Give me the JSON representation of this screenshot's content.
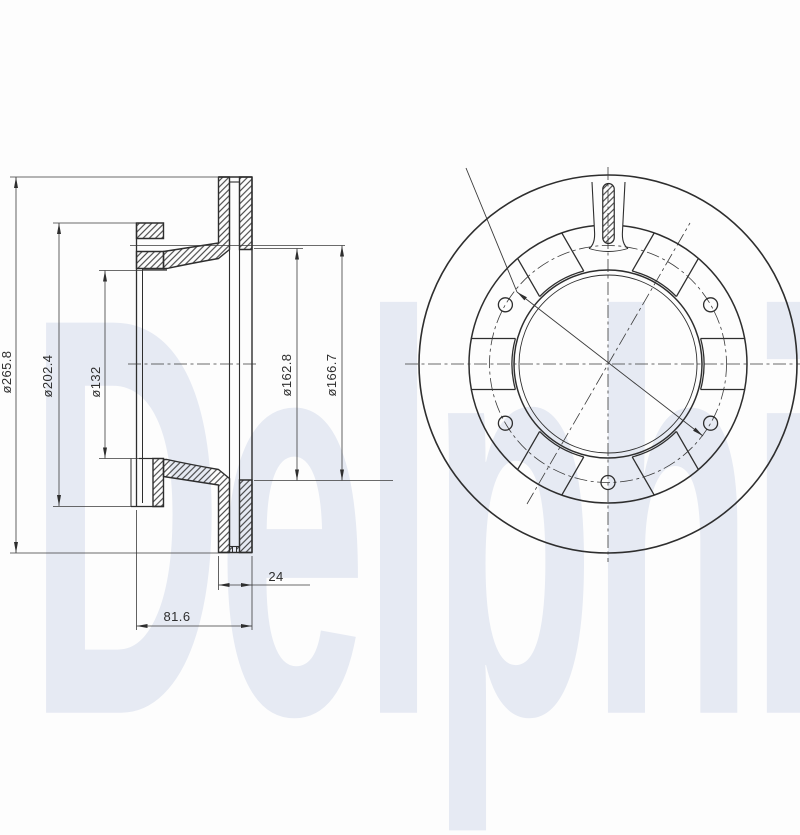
{
  "watermark": {
    "text": "Delphi",
    "color": "#e6eaf3"
  },
  "drawing": {
    "background": "#fdfdfd",
    "line_color": "#2e2e2e",
    "type": "brake-disc-technical-drawing",
    "section_view": {
      "dimensions": {
        "outer_diameter": "ø265.8",
        "flange_diameter": "ø202.4",
        "bore_diameter": "ø132",
        "vent_inner_diameter": "ø162.8",
        "bolt_circle_diameter": "ø166.7",
        "disc_thickness": "24",
        "overall_width": "81.6"
      }
    },
    "front_view": {
      "bolt_hole_count": 5,
      "window_count": 6,
      "has_top_slot": true
    }
  }
}
